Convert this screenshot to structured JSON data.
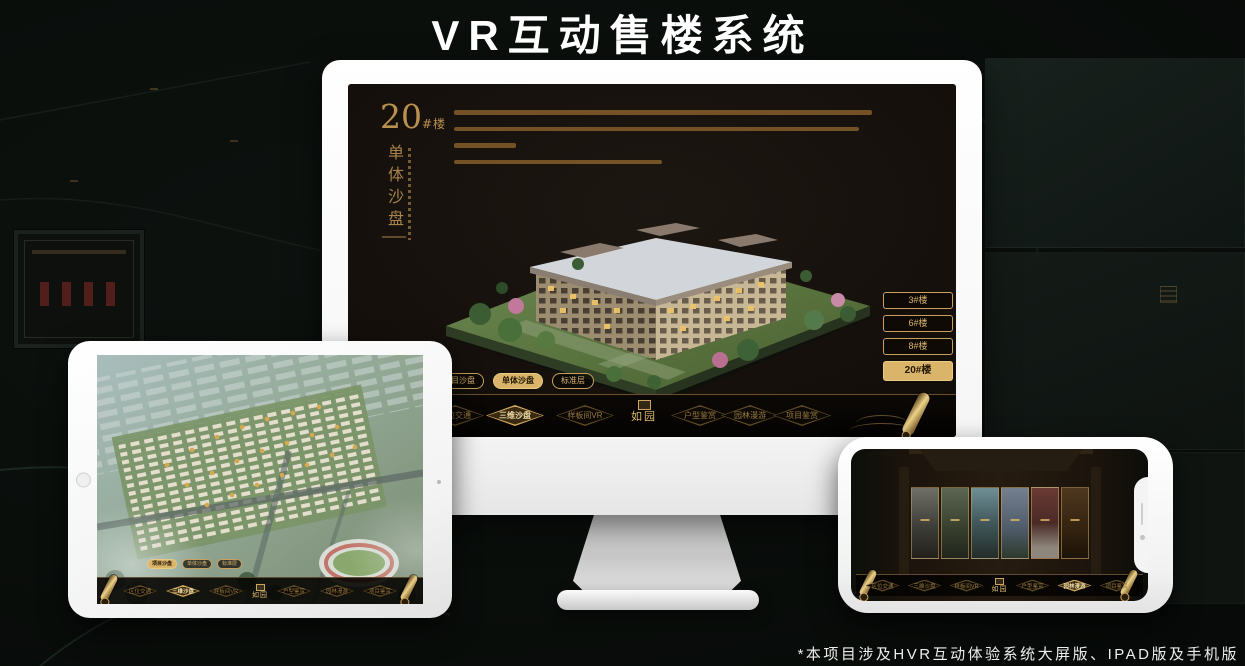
{
  "page": {
    "title": "VR互动售楼系统",
    "footnote": "*本项目涉及HVR互动体验系统大屏版、IPAD版及手机版"
  },
  "brand": {
    "logo": "如园"
  },
  "colors": {
    "gold": "#c9a05e",
    "gold_bright": "#e9ca80",
    "gold_fill": "#d9b469",
    "screen_bg": "#14100c",
    "nav_bg": "#070503",
    "page_bg": "#0b0f0c"
  },
  "desktop": {
    "heading": {
      "number": "20",
      "suffix": "#楼",
      "vertical": "单体沙盘"
    },
    "floor_buttons": [
      {
        "label": "3#楼",
        "active": false
      },
      {
        "label": "6#楼",
        "active": false
      },
      {
        "label": "8#楼",
        "active": false
      },
      {
        "label": "20#楼",
        "active": true
      }
    ],
    "subtabs": [
      {
        "label": "项目沙盘",
        "active": false
      },
      {
        "label": "单体沙盘",
        "active": true
      },
      {
        "label": "标准层",
        "active": false
      }
    ],
    "nav": {
      "items": [
        {
          "label": "区位交通",
          "active": false
        },
        {
          "label": "三维沙盘",
          "active": true
        },
        {
          "label": "样板间VR",
          "active": false
        },
        {
          "label": "户型鉴赏",
          "active": false
        },
        {
          "label": "园林漫游",
          "active": false
        },
        {
          "label": "项目鉴赏",
          "active": false
        }
      ]
    }
  },
  "tablet": {
    "subtabs": [
      {
        "label": "项目沙盘",
        "active": true
      },
      {
        "label": "单体沙盘",
        "active": false
      },
      {
        "label": "标准层",
        "active": false
      }
    ],
    "nav": {
      "items": [
        {
          "label": "区位交通",
          "active": false
        },
        {
          "label": "三维沙盘",
          "active": true
        },
        {
          "label": "样板间VR",
          "active": false
        },
        {
          "label": "户型鉴赏",
          "active": false
        },
        {
          "label": "园林漫游",
          "active": false
        },
        {
          "label": "项目鉴赏",
          "active": false
        }
      ]
    }
  },
  "phone": {
    "nav": {
      "items": [
        {
          "label": "区位交通",
          "active": false
        },
        {
          "label": "三维沙盘",
          "active": false
        },
        {
          "label": "样板间VR",
          "active": false
        },
        {
          "label": "户型鉴赏",
          "active": false
        },
        {
          "label": "园林漫游",
          "active": true
        },
        {
          "label": "项目鉴赏",
          "active": false
        }
      ]
    }
  }
}
